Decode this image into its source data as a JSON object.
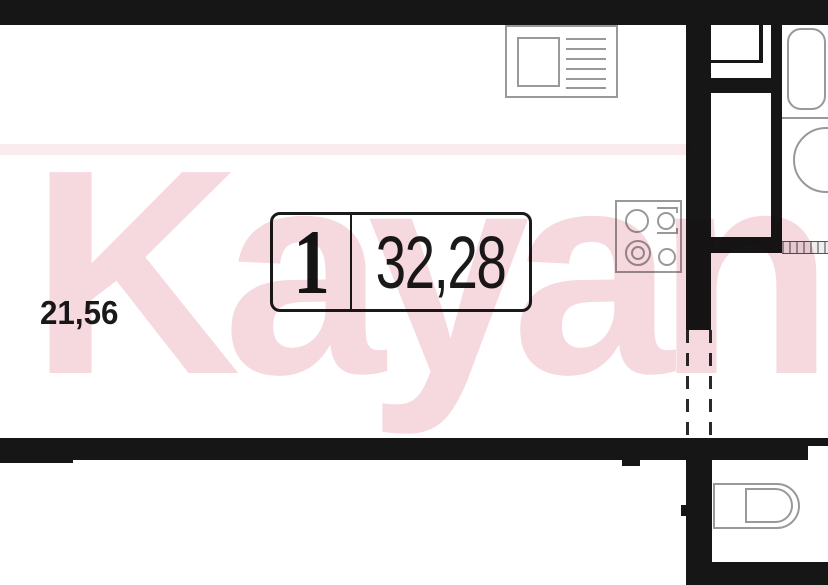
{
  "floor_plan": {
    "unit_number": "1",
    "unit_total_area": "32,28",
    "room_area": "21,56"
  },
  "watermark": {
    "text": "Kayan",
    "color": "#f6d8df"
  },
  "colors": {
    "background": "#ffffff",
    "wall": "#161616",
    "fixture_outline": "#999999",
    "label_text": "#1a1a1a"
  },
  "fixtures": {
    "kitchen_sink": "sink-with-drainer-icon",
    "stove": "four-burner-stove-icon",
    "bathtub": "bathtub-icon",
    "washbasin": "washbasin-icon",
    "toilet": "toilet-icon",
    "shaft": "ventilation-shaft",
    "opening": "dashed-opening"
  }
}
